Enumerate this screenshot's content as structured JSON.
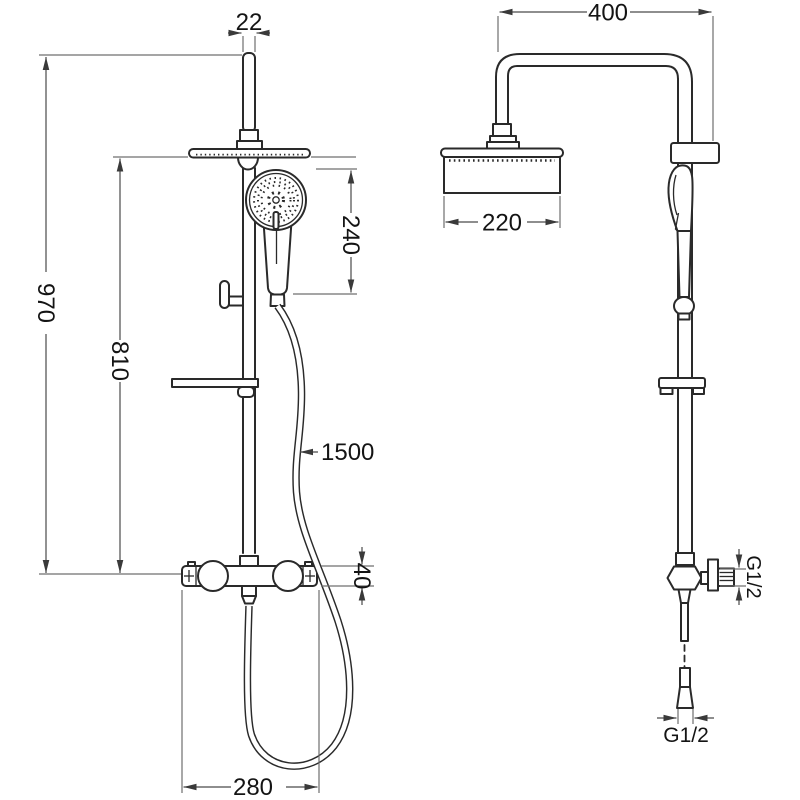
{
  "drawing": {
    "background": "#ffffff",
    "ink_color": "#2a2a2a",
    "dim_line_color": "#6f6f6f",
    "front_view": {
      "dims": {
        "pipe_width": "22",
        "total_height": "970",
        "rail_height": "810",
        "hand_shower_span": "240",
        "hose_length": "1500",
        "valve_height": "40",
        "valve_width": "280"
      }
    },
    "side_view": {
      "dims": {
        "arm_reach": "400",
        "head_width": "220",
        "inlet_thread": "G1/2",
        "hose_thread": "G1/2"
      }
    }
  }
}
